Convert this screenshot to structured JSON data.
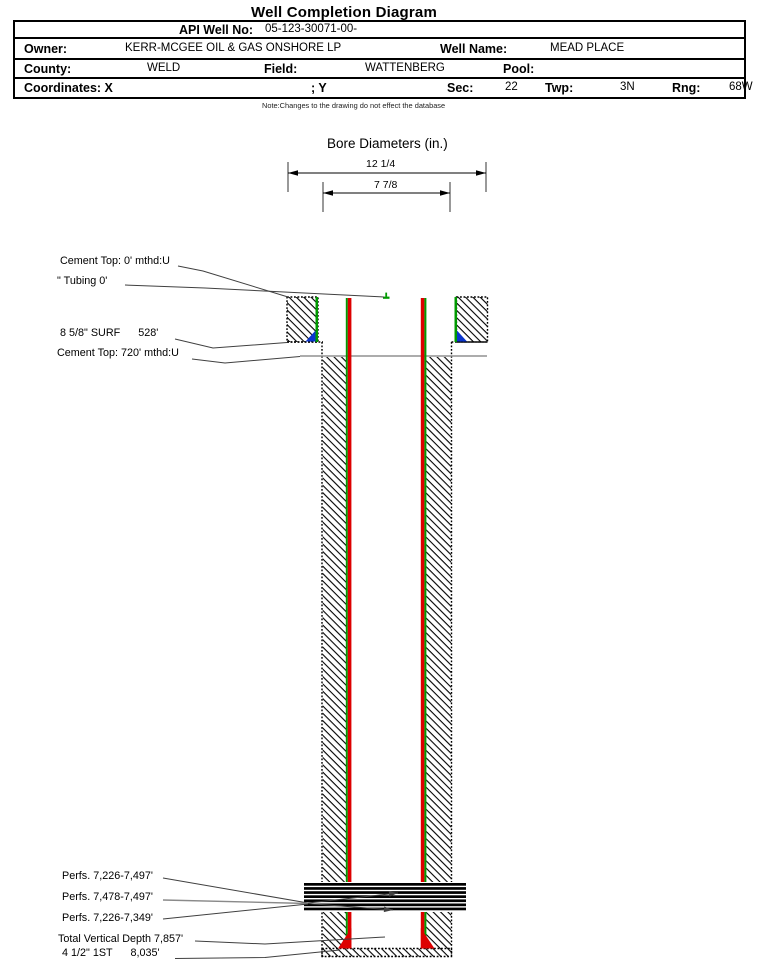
{
  "title": "Well Completion Diagram",
  "header": {
    "api_label": "API Well No:",
    "api_value": "05-123-30071-00-",
    "owner_label": "Owner:",
    "owner_value": "KERR-MCGEE OIL & GAS ONSHORE LP",
    "well_name_label": "Well Name:",
    "well_name_value": "MEAD PLACE",
    "county_label": "County:",
    "county_value": "WELD",
    "field_label": "Field:",
    "field_value": "WATTENBERG",
    "pool_label": "Pool:",
    "pool_value": "",
    "coordinates_label": "Coordinates: X",
    "y_label": "; Y",
    "sec_label": "Sec:",
    "sec_value": "22",
    "twp_label": "Twp:",
    "twp_value": "3N",
    "rng_label": "Rng:",
    "rng_value": "68W"
  },
  "note": "Note:Changes to the drawing do not effect the database",
  "bore_diameters": {
    "title": "Bore Diameters (in.)",
    "outer_diameter": "12 1/4",
    "inner_diameter": "7 7/8"
  },
  "annotations": {
    "cement_top_surface": "Cement Top: 0' mthd:U",
    "tubing": "\" Tubing 0'",
    "surface_casing": "8 5/8\" SURF      528'",
    "cement_top_production": "Cement Top: 720' mthd:U",
    "perfs_1": "Perfs. 7,226-7,497'",
    "perfs_2": "Perfs. 7,478-7,497'",
    "perfs_3": "Perfs. 7,226-7,349'",
    "total_vertical_depth": "Total Vertical Depth 7,857'",
    "production_casing": "4 1/2\" 1ST      8,035'"
  },
  "colors": {
    "casing_green": "#009900",
    "casing_red": "#dd0000",
    "shoe_blue": "#0a35cc",
    "cement_line_gray": "#909090"
  }
}
